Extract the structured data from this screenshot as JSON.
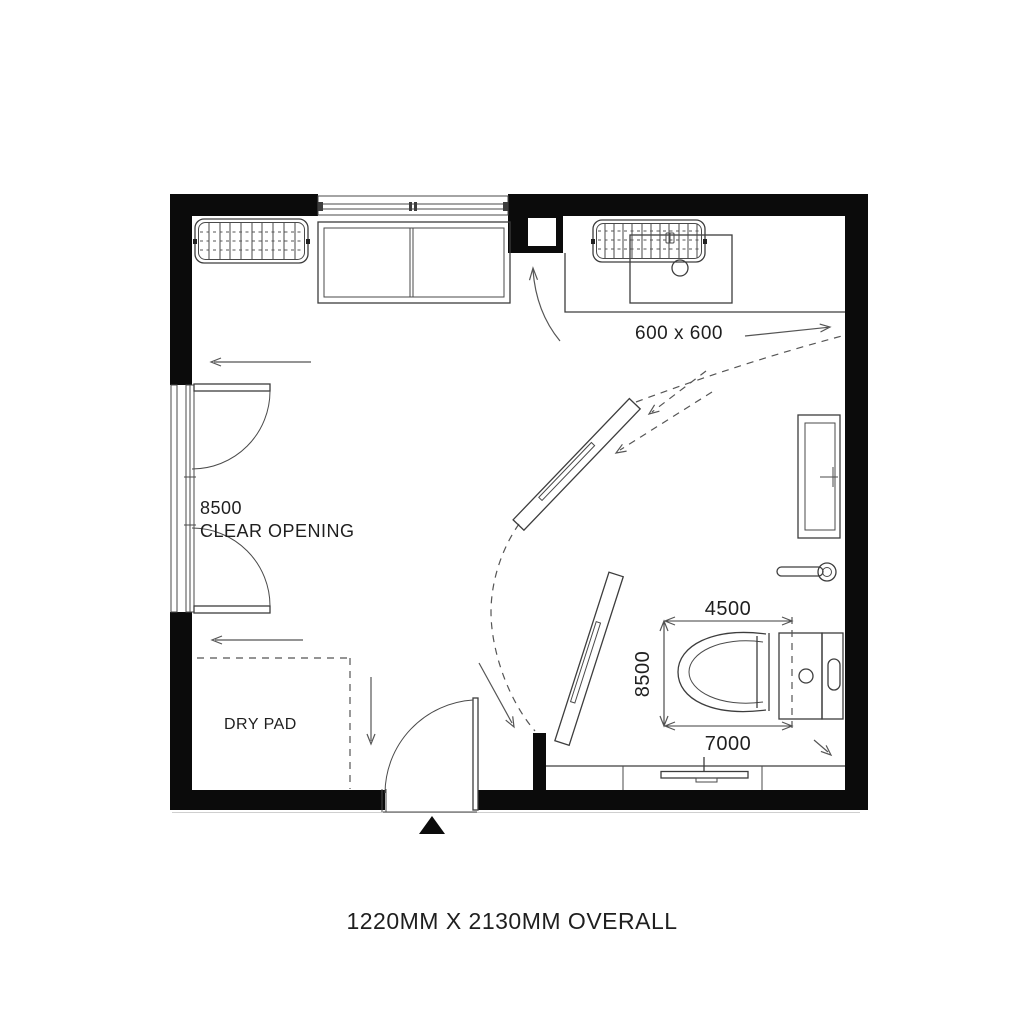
{
  "plan": {
    "background": "#ffffff",
    "wall_color": "#0b0b0b",
    "line_color": "#3d3d3d",
    "annotations": {
      "grille_size": "600 x 600",
      "clear_opening_value": "8500",
      "clear_opening_label": "CLEAR OPENING",
      "dry_pad_label": "DRY PAD",
      "dim_top": "4500",
      "dim_side": "8500",
      "dim_bottom": "7000",
      "overall_note": "1220MM X 2130MM OVERALL"
    }
  }
}
